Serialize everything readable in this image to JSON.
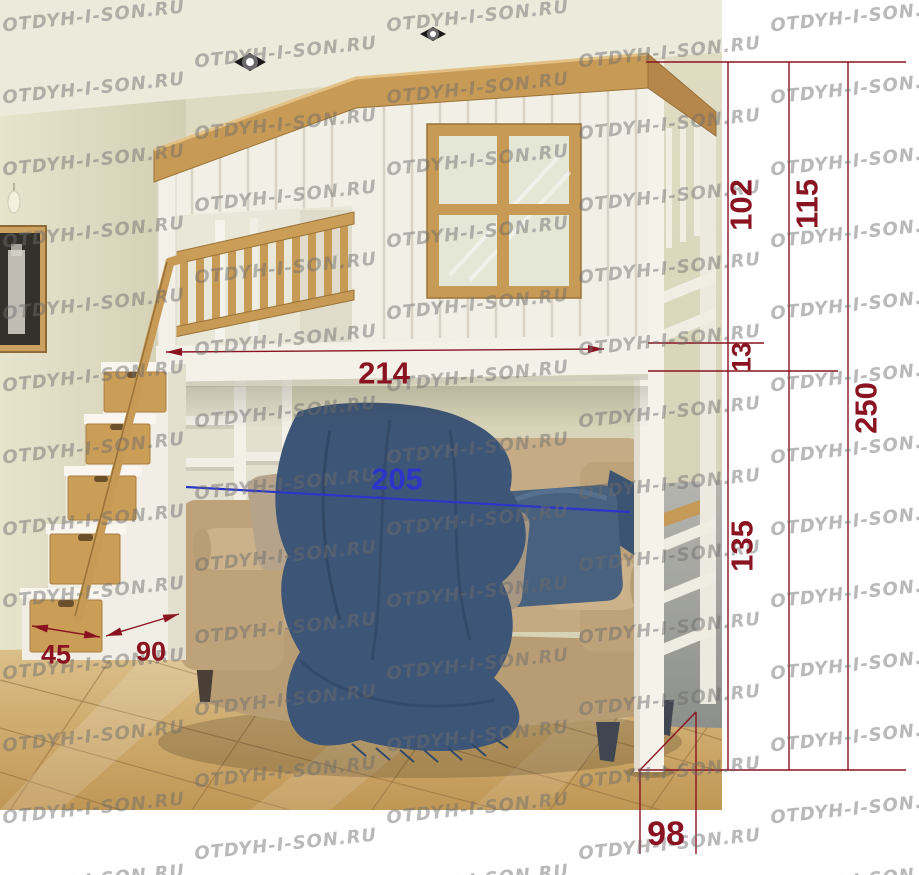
{
  "watermark": {
    "text": "OTDYH-I-SON.RU"
  },
  "scene": {
    "description": "3D room render of a white loft bed with play-house upper bunk, wooden window frame and railing, drawer staircase on the left, beige sofa with blue pillows and blanket underneath, glossy beige tiled floor",
    "colors": {
      "dimension_red": "#8a1322",
      "dimension_blue": "#2b36c9",
      "wood": "#c79a55",
      "frame_white": "#f3f0e8",
      "wall": "#dedbc2",
      "floor_tile": "#cda868",
      "sofa": "#c3aa85",
      "textile_blue": "#3d5577"
    }
  },
  "dimensions": {
    "upper_section_height": "102",
    "upper_section_with_platform": "115",
    "platform_thickness": "13",
    "total_height": "250",
    "under_bed_clearance": "135",
    "bed_length": "214",
    "sofa_length": "205",
    "step_depth": "45",
    "stair_width": "90",
    "bed_depth": "98"
  }
}
